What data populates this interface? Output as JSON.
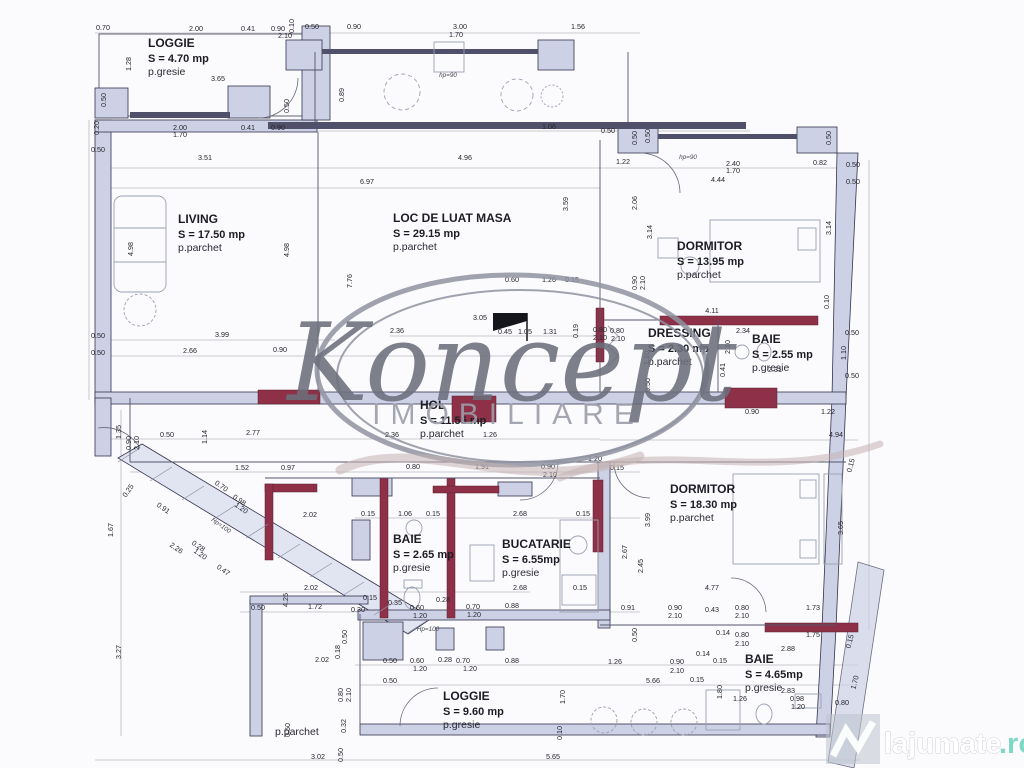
{
  "watermark": {
    "brand": "Koncept",
    "subtitle": "IMOBILIARE"
  },
  "site": {
    "name": "lajumate",
    "tld": ".ro"
  },
  "colors": {
    "paper": "#fbfbfd",
    "wall": "#cdd1e6",
    "wallStroke": "#32324e",
    "accent": "#8e3048",
    "glaz": "#50506a",
    "dim": "#26262e",
    "furn": "#9aa0b0",
    "watermark": "#6c6f7c",
    "watermarkLight": "#9b9ea9",
    "siteTeal": "#7fd8c6"
  },
  "rooms": [
    {
      "name": "LOGGIE",
      "area": "S = 4.70 mp",
      "floor": "p.gresie",
      "x": 148,
      "y": 47
    },
    {
      "name": "LIVING",
      "area": "S = 17.50 mp",
      "floor": "p.parchet",
      "x": 178,
      "y": 223
    },
    {
      "name": "LOC DE LUAT MASA",
      "area": "S = 29.15 mp",
      "floor": "p.parchet",
      "x": 393,
      "y": 222
    },
    {
      "name": "DORMITOR",
      "area": "S = 13.95 mp",
      "floor": "p.parchet",
      "x": 677,
      "y": 250
    },
    {
      "name": "DRESSING",
      "area": "S = 2.30 mp",
      "floor": "p.parchet",
      "x": 648,
      "y": 337
    },
    {
      "name": "BAIE",
      "area": "S = 2.55 mp",
      "floor": "p.gresie",
      "x": 752,
      "y": 343
    },
    {
      "name": "HOL",
      "area": "S = 11.55 mp",
      "floor": "p.parchet",
      "x": 420,
      "y": 409
    },
    {
      "name": "DORMITOR",
      "area": "S = 18.30 mp",
      "floor": "p.parchet",
      "x": 670,
      "y": 493
    },
    {
      "name": "BAIE",
      "area": "S = 2.65 mp",
      "floor": "p.gresie",
      "x": 393,
      "y": 543
    },
    {
      "name": "BUCATARIE",
      "area": "S = 6.55mp",
      "floor": "p.gresie",
      "x": 502,
      "y": 548
    },
    {
      "name": "BAIE",
      "area": "S = 4.65mp",
      "floor": "p.gresie",
      "x": 745,
      "y": 663
    },
    {
      "name": "LOGGIE",
      "area": "S = 9.60 mp",
      "floor": "p.gresie",
      "x": 443,
      "y": 700
    },
    {
      "name": "",
      "area": "",
      "floor": "p.parchet",
      "x": 275,
      "y": 707
    }
  ],
  "dims": [
    [
      "0.70",
      103,
      30
    ],
    [
      "2.00",
      196,
      31
    ],
    [
      "0.41",
      248,
      31
    ],
    [
      "0.90",
      278,
      31
    ],
    [
      "2.10",
      285,
      38
    ],
    [
      "0.10",
      294,
      26,
      -90
    ],
    [
      "0.50",
      312,
      29
    ],
    [
      "0.90",
      354,
      29
    ],
    [
      "3.00",
      460,
      29
    ],
    [
      "1.70",
      456,
      37
    ],
    [
      "1.56",
      578,
      29
    ],
    [
      "1.28",
      131,
      64,
      -90
    ],
    [
      "3.65",
      218,
      81
    ],
    [
      "0.50",
      106,
      100,
      -90
    ],
    [
      "0.50",
      289,
      106,
      -90
    ],
    [
      "0.89",
      344,
      95,
      -90
    ],
    [
      "hp=90",
      448,
      77
    ],
    [
      "0.20",
      99,
      128,
      -90
    ],
    [
      "2.00",
      180,
      130
    ],
    [
      "1.70",
      180,
      137
    ],
    [
      "0.41",
      248,
      130
    ],
    [
      "0.90",
      278,
      130
    ],
    [
      "1.06",
      549,
      129
    ],
    [
      "0.50",
      98,
      152
    ],
    [
      "0.50",
      608,
      133
    ],
    [
      "0.50",
      637,
      138,
      -90
    ],
    [
      "0.50",
      650,
      136,
      -90
    ],
    [
      "0.50",
      831,
      138,
      -90
    ],
    [
      "hp=90",
      688,
      159
    ],
    [
      "1.22",
      623,
      164
    ],
    [
      "2.40",
      733,
      166
    ],
    [
      "1.70",
      733,
      173
    ],
    [
      "0.82",
      820,
      165
    ],
    [
      "0.50",
      853,
      167
    ],
    [
      "0.50",
      853,
      184
    ],
    [
      "4.44",
      718,
      182
    ],
    [
      "3.51",
      205,
      160
    ],
    [
      "4.96",
      465,
      160
    ],
    [
      "6.97",
      367,
      184
    ],
    [
      "4.98",
      133,
      249,
      -90
    ],
    [
      "4.98",
      289,
      250,
      -90
    ],
    [
      "7.76",
      352,
      281,
      -90
    ],
    [
      "2.06",
      637,
      203,
      -90
    ],
    [
      "3.14",
      652,
      232,
      -90
    ],
    [
      "3.14",
      831,
      228,
      -90
    ],
    [
      "0.90",
      637,
      283,
      -90
    ],
    [
      "2.10",
      645,
      283,
      -90
    ],
    [
      "0.10",
      829,
      302,
      -90
    ],
    [
      "3.99",
      222,
      337
    ],
    [
      "2.66",
      190,
      353
    ],
    [
      "0.90",
      280,
      352
    ],
    [
      "0.50",
      98,
      338
    ],
    [
      "0.50",
      98,
      355
    ],
    [
      "3.59",
      568,
      204,
      -90
    ],
    [
      "2.36",
      397,
      333
    ],
    [
      "3.05",
      480,
      320
    ],
    [
      "0.45",
      505,
      334
    ],
    [
      "1.05",
      525,
      334
    ],
    [
      "1.31",
      550,
      334
    ],
    [
      "0.60",
      512,
      282
    ],
    [
      "1.26",
      549,
      282
    ],
    [
      "0.15",
      572,
      282
    ],
    [
      "0.19",
      578,
      331,
      -90
    ],
    [
      "0.80",
      600,
      332
    ],
    [
      "2.10",
      600,
      340
    ],
    [
      "4.11",
      712,
      313
    ],
    [
      "0.80",
      617,
      333
    ],
    [
      "2.10",
      618,
      341
    ],
    [
      "1.10",
      649,
      358,
      -90
    ],
    [
      "0.50",
      650,
      385,
      -90
    ],
    [
      "2.10",
      730,
      347,
      -90
    ],
    [
      "0.41",
      725,
      370,
      -90
    ],
    [
      "2.34",
      743,
      333
    ],
    [
      "2.31",
      775,
      372
    ],
    [
      "1.10",
      846,
      353,
      -90
    ],
    [
      "0.50",
      852,
      335
    ],
    [
      "0.50",
      852,
      378
    ],
    [
      "0.90",
      752,
      414
    ],
    [
      "1.22",
      828,
      414
    ],
    [
      "4.94",
      836,
      437
    ],
    [
      "1.35",
      121,
      432,
      -90
    ],
    [
      "0.90",
      131,
      443,
      -90
    ],
    [
      "2.10",
      139,
      443,
      -90
    ],
    [
      "0.50",
      167,
      437
    ],
    [
      "1.14",
      207,
      437,
      -90
    ],
    [
      "2.77",
      253,
      435
    ],
    [
      "2.36",
      392,
      437
    ],
    [
      "1.26",
      490,
      437
    ],
    [
      "1.52",
      242,
      470
    ],
    [
      "0.97",
      288,
      470
    ],
    [
      "0.80",
      413,
      469
    ],
    [
      "1.91",
      482,
      469
    ],
    [
      "0.90",
      548,
      469
    ],
    [
      "2.10",
      550,
      477
    ],
    [
      "1.20",
      595,
      461
    ],
    [
      "0.15",
      617,
      470
    ],
    [
      "0.25",
      130,
      492,
      -55
    ],
    [
      "0.91",
      162,
      510,
      35
    ],
    [
      "2.26",
      175,
      550,
      35
    ],
    [
      "0.70",
      220,
      488,
      35
    ],
    [
      "0.98",
      238,
      502,
      35
    ],
    [
      "1.20",
      240,
      510,
      35
    ],
    [
      "0.28",
      197,
      548,
      35
    ],
    [
      "1.20",
      199,
      556,
      35
    ],
    [
      "0.47",
      222,
      572,
      35
    ],
    [
      "Hp=100",
      220,
      527,
      35
    ],
    [
      "1.67",
      113,
      530,
      -90
    ],
    [
      "3.27",
      121,
      652,
      -90
    ],
    [
      "2.02",
      310,
      517
    ],
    [
      "2.02",
      311,
      590
    ],
    [
      "2.02",
      322,
      662
    ],
    [
      "0.15",
      368,
      516
    ],
    [
      "1.06",
      405,
      516
    ],
    [
      "0.15",
      433,
      516
    ],
    [
      "2.68",
      520,
      516
    ],
    [
      "0.15",
      583,
      516
    ],
    [
      "2.45",
      643,
      566,
      -90
    ],
    [
      "3.99",
      650,
      520,
      -90
    ],
    [
      "3.65",
      843,
      528,
      -90
    ],
    [
      "2.67",
      627,
      552,
      -90
    ],
    [
      "4.25",
      288,
      600,
      -90
    ],
    [
      "0.50",
      258,
      610
    ],
    [
      "1.72",
      315,
      609
    ],
    [
      "0.30",
      358,
      612
    ],
    [
      "0.15",
      370,
      600
    ],
    [
      "0.35",
      395,
      605
    ],
    [
      "0.60",
      417,
      610
    ],
    [
      "1.20",
      420,
      618
    ],
    [
      "0.28",
      443,
      602
    ],
    [
      "0.70",
      473,
      609
    ],
    [
      "1.20",
      474,
      617
    ],
    [
      "0.88",
      512,
      608
    ],
    [
      "Hp=100",
      428,
      631
    ],
    [
      "0.50",
      347,
      637,
      -90
    ],
    [
      "0.18",
      340,
      652,
      -90
    ],
    [
      "0.50",
      390,
      663
    ],
    [
      "0.60",
      417,
      663
    ],
    [
      "1.20",
      420,
      671
    ],
    [
      "0.28",
      445,
      662
    ],
    [
      "0.70",
      463,
      663
    ],
    [
      "1.20",
      470,
      671
    ],
    [
      "0.88",
      512,
      663
    ],
    [
      "0.50",
      390,
      683
    ],
    [
      "0.80",
      343,
      695,
      -90
    ],
    [
      "2.10",
      351,
      695,
      -90
    ],
    [
      "2.68",
      520,
      590
    ],
    [
      "0.15",
      580,
      590
    ],
    [
      "5.66",
      653,
      683
    ],
    [
      "1.70",
      565,
      697,
      -90
    ],
    [
      "0.10",
      562,
      733,
      -90
    ],
    [
      "5.65",
      553,
      759
    ],
    [
      "3.02",
      318,
      759
    ],
    [
      "0.50",
      343,
      755,
      -90
    ],
    [
      "0.32",
      346,
      726,
      -90
    ],
    [
      "0.50",
      290,
      730,
      -90
    ],
    [
      "4.77",
      712,
      590
    ],
    [
      "0.91",
      628,
      610
    ],
    [
      "0.90",
      675,
      610
    ],
    [
      "2.10",
      675,
      618
    ],
    [
      "0.43",
      712,
      612
    ],
    [
      "0.80",
      742,
      610
    ],
    [
      "2.10",
      742,
      618
    ],
    [
      "1.73",
      813,
      610
    ],
    [
      "0.50",
      637,
      635,
      -90
    ],
    [
      "0.14",
      703,
      656
    ],
    [
      "0.14",
      723,
      635
    ],
    [
      "0.80",
      742,
      637
    ],
    [
      "2.10",
      742,
      646
    ],
    [
      "1.75",
      813,
      637
    ],
    [
      "2.88",
      788,
      651
    ],
    [
      "1.26",
      615,
      664
    ],
    [
      "0.90",
      677,
      664
    ],
    [
      "2.10",
      677,
      673
    ],
    [
      "0.15",
      697,
      682
    ],
    [
      "0.15",
      720,
      663
    ],
    [
      "1.80",
      722,
      692,
      -90
    ],
    [
      "2.83",
      788,
      693
    ],
    [
      "0.98",
      797,
      701
    ],
    [
      "1.20",
      798,
      709
    ],
    [
      "0.80",
      842,
      705
    ],
    [
      "1.26",
      740,
      701
    ],
    [
      "0.15",
      853,
      466,
      -75
    ],
    [
      "0.15",
      852,
      642,
      -75
    ],
    [
      "1.70",
      857,
      683,
      -75
    ]
  ]
}
